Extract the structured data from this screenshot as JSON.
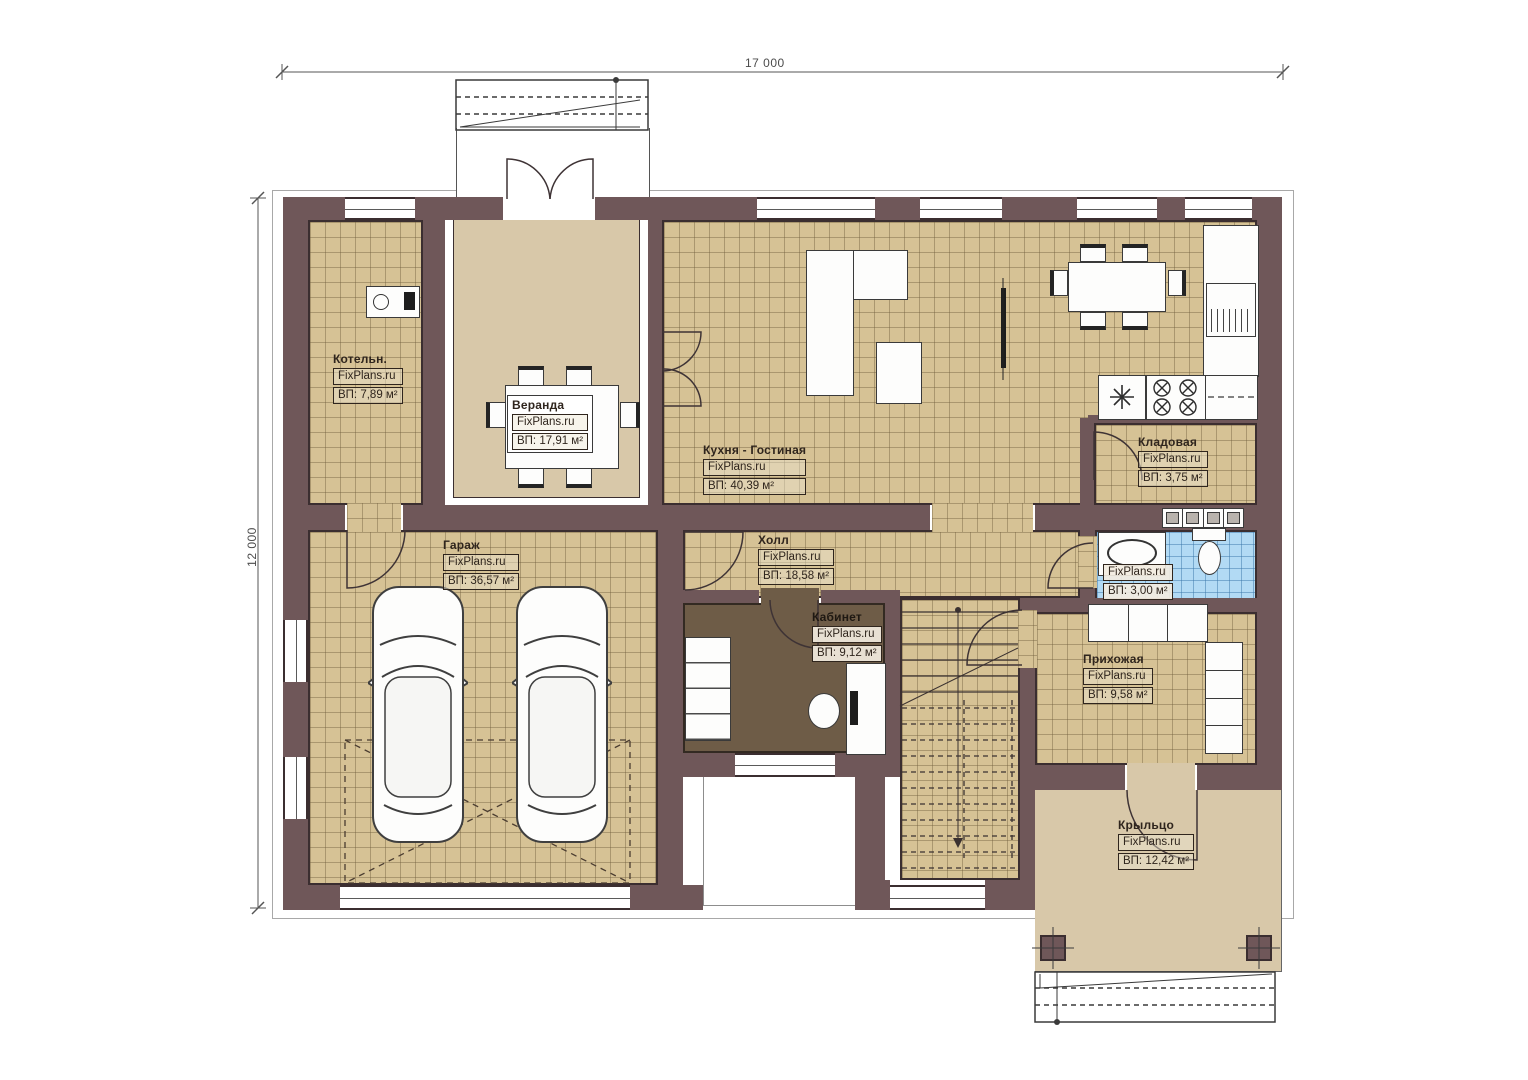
{
  "dimensions": {
    "top": "17 000",
    "left": "12 000"
  },
  "rooms": [
    {
      "name": "Котельн.",
      "brand": "FixPlans.ru",
      "area": "ВП: 7,89 м²"
    },
    {
      "name": "Веранда",
      "brand": "FixPlans.ru",
      "area": "ВП: 17,91 м²"
    },
    {
      "name": "Кухня - Гостиная",
      "brand": "FixPlans.ru",
      "area": "ВП:  40,39 м²"
    },
    {
      "name": "Кладовая",
      "brand": "FixPlans.ru",
      "area": "ВП: 3,75 м²"
    },
    {
      "name": "Гараж",
      "brand": "FixPlans.ru",
      "area": "ВП: 36,57 м²"
    },
    {
      "name": "Холл",
      "brand": "FixPlans.ru",
      "area": "ВП: 18,58 м²"
    },
    {
      "name": "Кабинет",
      "brand": "FixPlans.ru",
      "area": "ВП: 9,12 м²"
    },
    {
      "name": "",
      "brand": "FixPlans.ru",
      "area": "ВП: 3,00 м²"
    },
    {
      "name": "Прихожая",
      "brand": "FixPlans.ru",
      "area": "ВП: 9,58 м²"
    },
    {
      "name": "Крыльцо",
      "brand": "FixPlans.ru",
      "area": "ВП: 12,42 м²"
    }
  ],
  "colors": {
    "wall": "#6f5759",
    "floor_tile": "#d6c295",
    "floor_wood": "#d8c8a9",
    "bathroom_tile": "#b2daf4",
    "office_floor": "#6e5c47"
  }
}
